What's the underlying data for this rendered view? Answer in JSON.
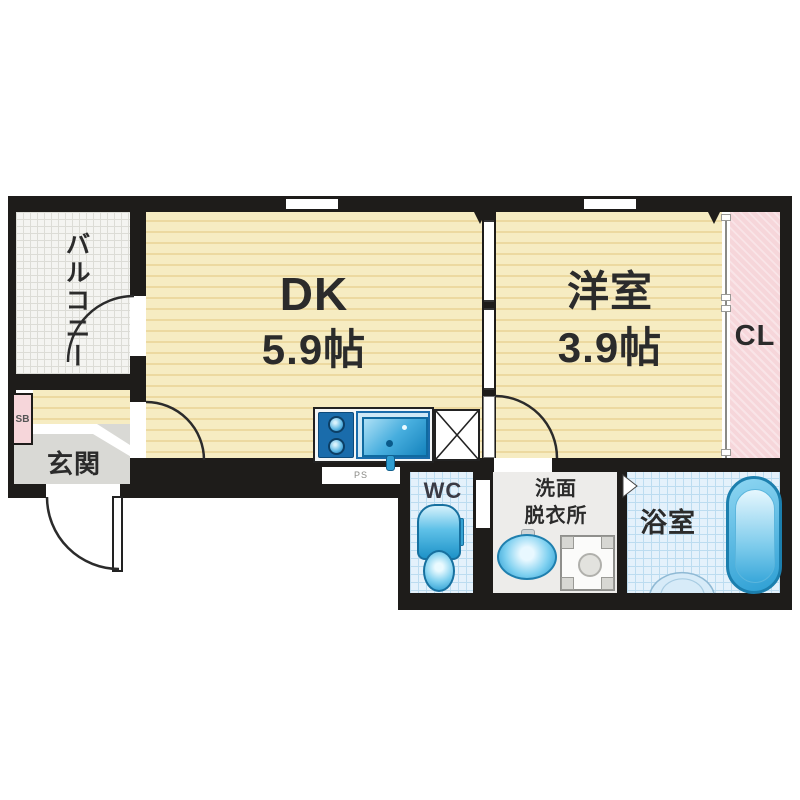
{
  "plan": {
    "balcony": {
      "label": "バルコニー"
    },
    "dk": {
      "label": "DK",
      "size": "5.9帖"
    },
    "western_room": {
      "label": "洋室",
      "size": "3.9帖"
    },
    "closet": {
      "label": "CL"
    },
    "entrance": {
      "label": "玄関"
    },
    "shoe_box": {
      "label": "SB"
    },
    "pipe_space": {
      "label": "PS"
    },
    "wc": {
      "label": "WC"
    },
    "washroom": {
      "line1": "洗面",
      "line2": "脱衣所"
    },
    "bathroom": {
      "label": "浴室"
    }
  },
  "colors": {
    "wall": "#1e1c1a",
    "room_floor": "#f6ecc2",
    "room_floor_stripe": "#ecd9a0",
    "balcony_floor": "#f4f4f1",
    "closet_pink": "#f6d6da",
    "entrance_gray": "#d9d9d5",
    "wet_tile": "#e4f1fb",
    "wet_tile_grid": "#bcdcf0",
    "washroom_floor": "#edecea",
    "fixture_blue": "#2196cd",
    "fixture_blue_light": "#bfe7f7",
    "text": "#2b2b2b"
  }
}
